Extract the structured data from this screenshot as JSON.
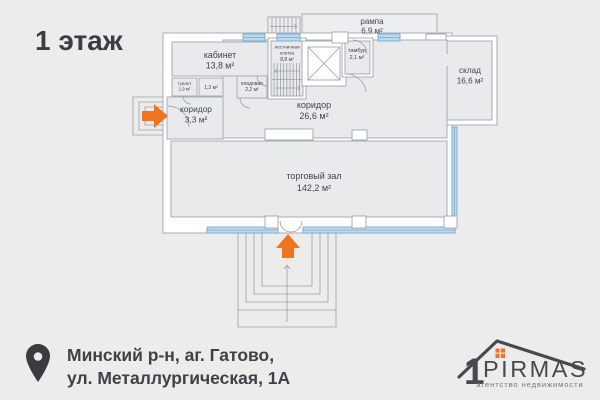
{
  "page": {
    "background": "#ececec"
  },
  "title": "1 этаж",
  "plan": {
    "rooms": {
      "office": {
        "label": "кабинет",
        "area": "13,8 м²"
      },
      "stairwell": {
        "label_line1": "лестничная",
        "label_line2": "клетка",
        "area": "8,8 м²"
      },
      "ramp": {
        "label": "рампа",
        "area": "6,9 м²"
      },
      "vestibule": {
        "label": "тамбур",
        "area": "2,1 м²"
      },
      "warehouse": {
        "label": "склад",
        "area": "16,6 м²"
      },
      "toilet": {
        "label": "туалет",
        "area": "1,9 м²"
      },
      "utility": {
        "area": "1,3 м²"
      },
      "storage": {
        "label": "кладовая",
        "area": "2,2 м²"
      },
      "corridor_small": {
        "label": "коридор",
        "area": "3,3 м²"
      },
      "corridor_main": {
        "label": "коридор",
        "area": "26,6 м²"
      },
      "sales_hall": {
        "label": "торговый зал",
        "area": "142,2 м²"
      }
    },
    "icons": [
      "entrance-arrow-right",
      "entrance-arrow-up",
      "elevator-shaft",
      "staircase"
    ]
  },
  "address": {
    "line1": "Минский р-н, аг. Гатово,",
    "line2": "ул. Металлургическая, 1А"
  },
  "logo": {
    "digit": "1",
    "name": "PIRMAS",
    "tagline": "агентство недвижимости"
  },
  "colors": {
    "accent_orange": "#f0731f",
    "window_blue": "#b9dbf2",
    "window_blue_stroke": "#74abd6",
    "text_dark": "#3a3d42",
    "plan_text": "#41464b",
    "logo_dark": "#46494e",
    "logo_gray": "#75787d"
  }
}
